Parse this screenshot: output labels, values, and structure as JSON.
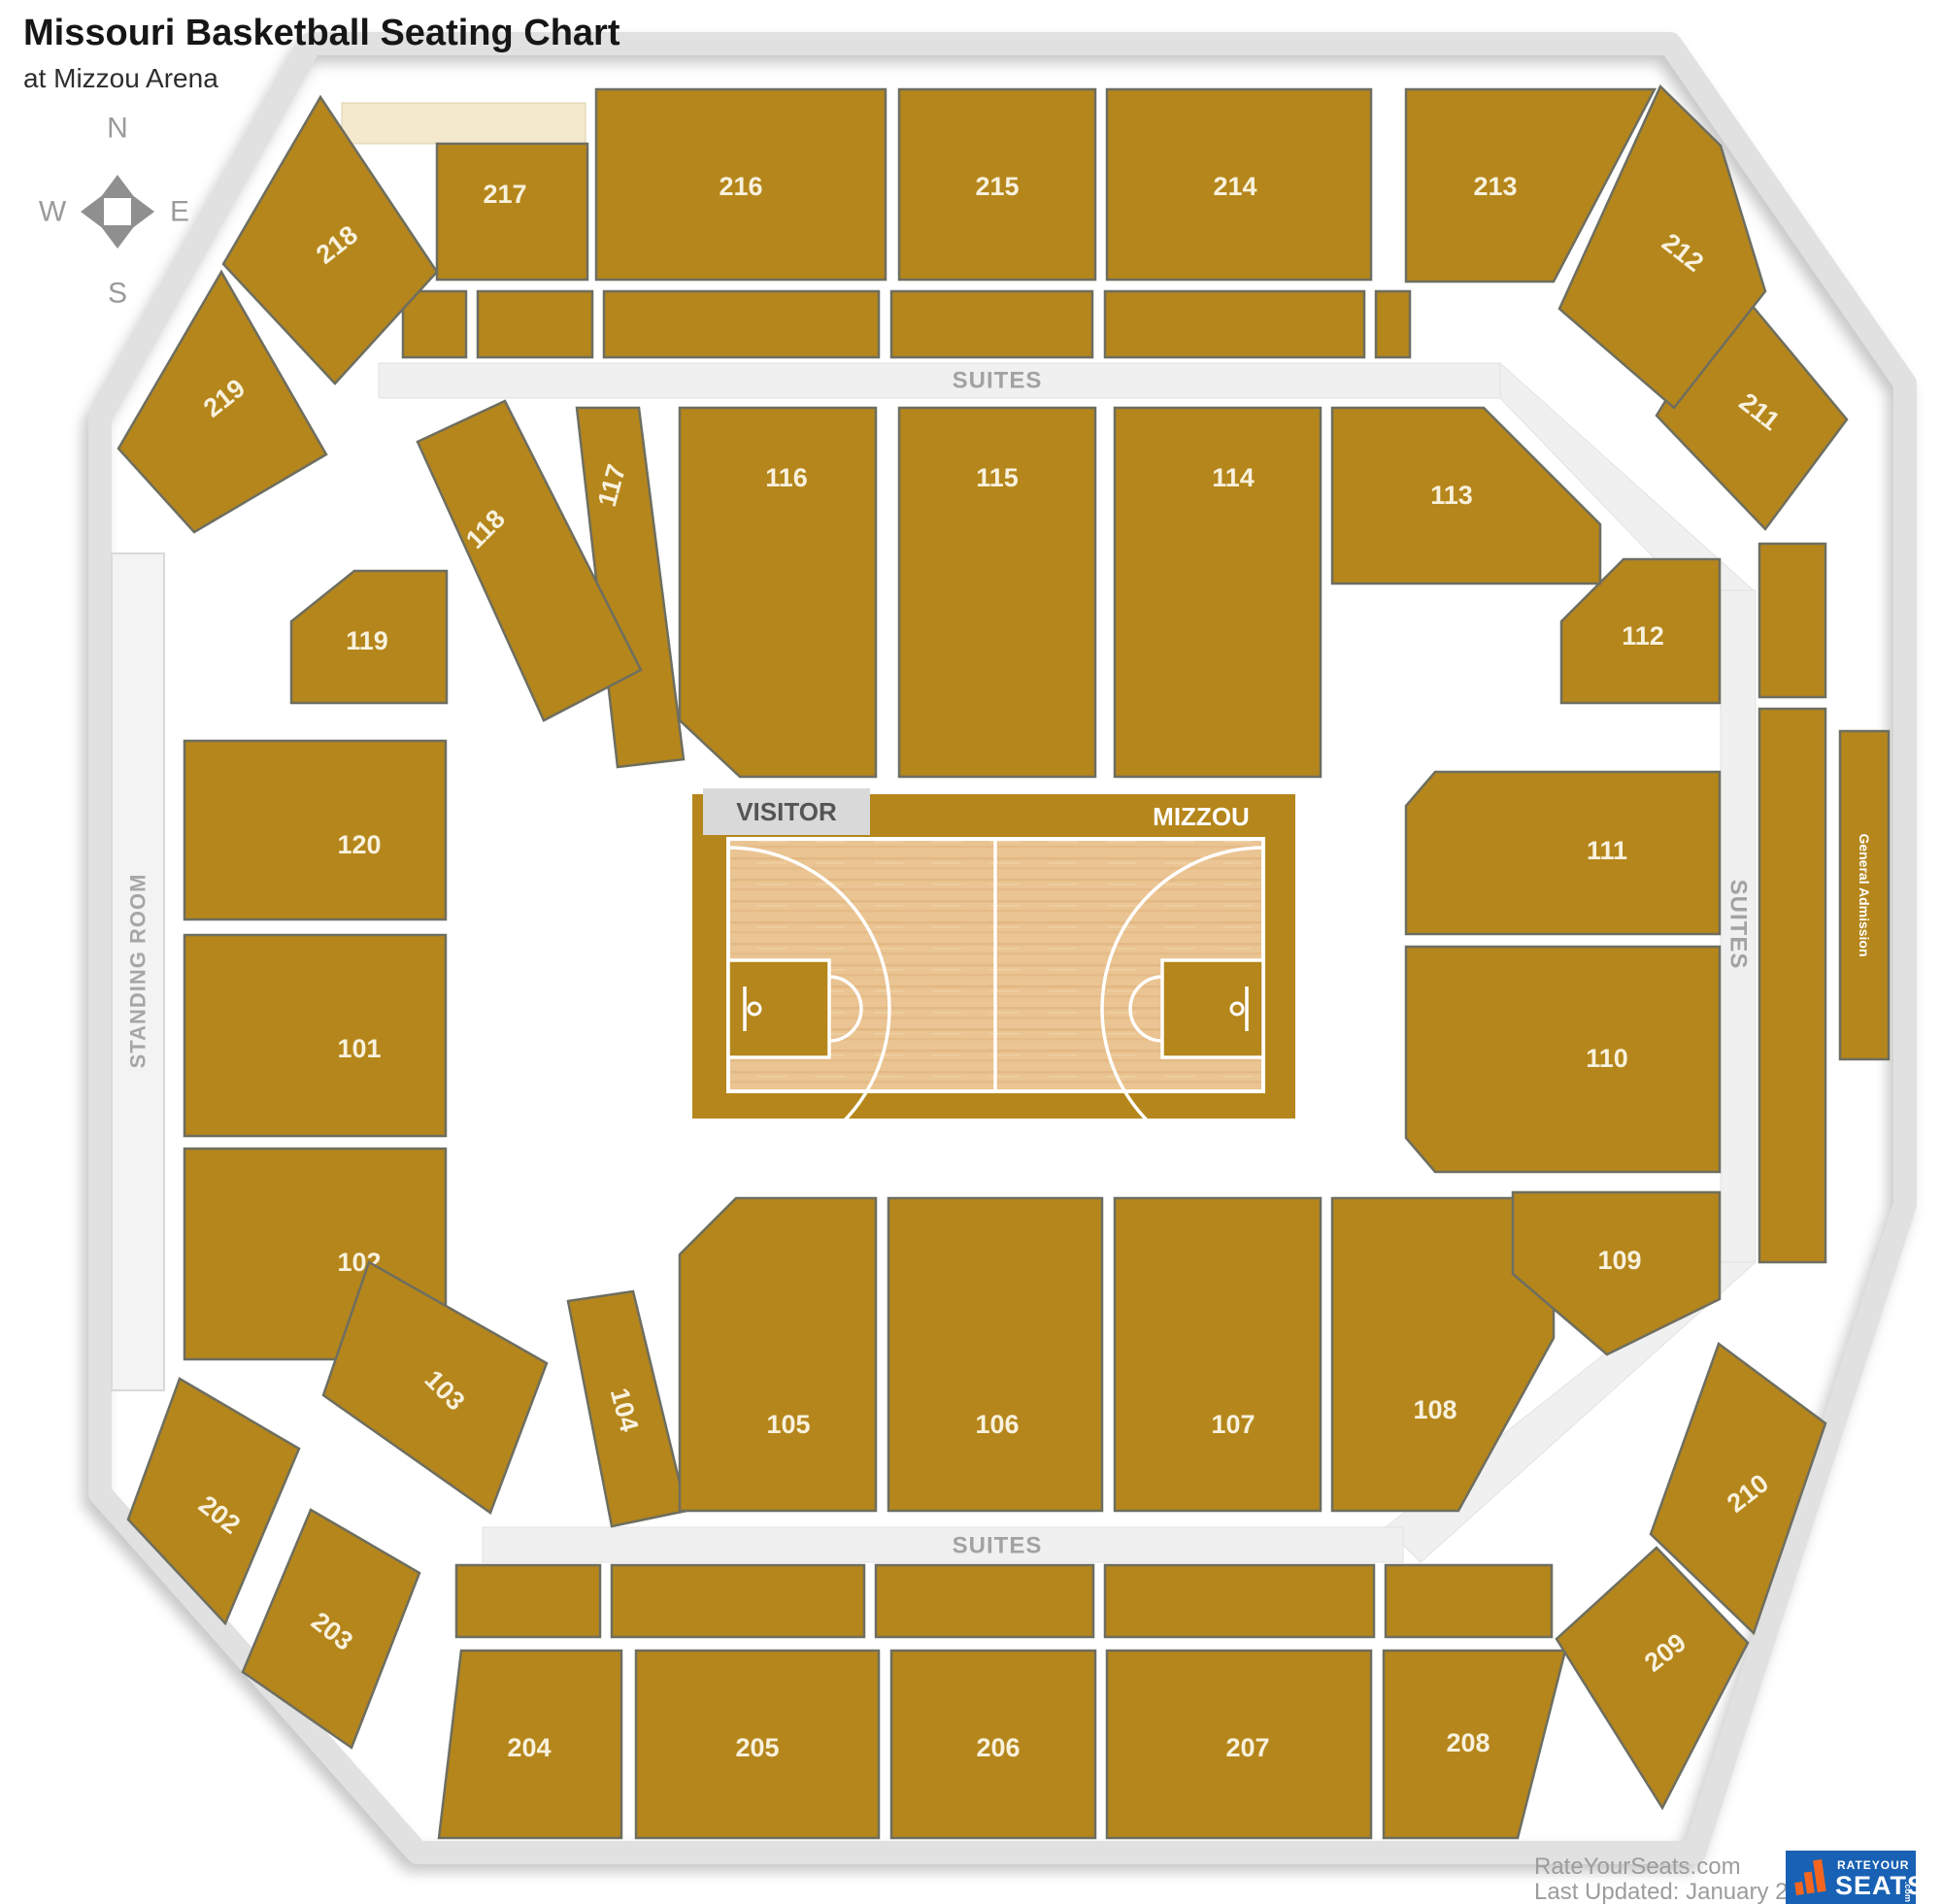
{
  "header": {
    "title": "Missouri Basketball Seating Chart",
    "subtitle": "at Mizzou Arena"
  },
  "compass": {
    "north": "N",
    "west": "W",
    "east": "E",
    "south": "S"
  },
  "areas": {
    "suites_top": "SUITES",
    "suites_bottom": "SUITES",
    "suites_right": "SUITES",
    "standing_room": "STANDING ROOM",
    "general_admission": "General Admission"
  },
  "court": {
    "visitor_bench": "VISITOR",
    "home_bench": "MIZZOU"
  },
  "sections": [
    {
      "id": "101",
      "label": "101"
    },
    {
      "id": "102",
      "label": "102"
    },
    {
      "id": "103",
      "label": "103"
    },
    {
      "id": "104",
      "label": "104"
    },
    {
      "id": "105",
      "label": "105"
    },
    {
      "id": "106",
      "label": "106"
    },
    {
      "id": "107",
      "label": "107"
    },
    {
      "id": "108",
      "label": "108"
    },
    {
      "id": "109",
      "label": "109"
    },
    {
      "id": "110",
      "label": "110"
    },
    {
      "id": "111",
      "label": "111"
    },
    {
      "id": "112",
      "label": "112"
    },
    {
      "id": "113",
      "label": "113"
    },
    {
      "id": "114",
      "label": "114"
    },
    {
      "id": "115",
      "label": "115"
    },
    {
      "id": "116",
      "label": "116"
    },
    {
      "id": "117",
      "label": "117"
    },
    {
      "id": "118",
      "label": "118"
    },
    {
      "id": "119",
      "label": "119"
    },
    {
      "id": "120",
      "label": "120"
    },
    {
      "id": "202",
      "label": "202"
    },
    {
      "id": "203",
      "label": "203"
    },
    {
      "id": "204",
      "label": "204"
    },
    {
      "id": "205",
      "label": "205"
    },
    {
      "id": "206",
      "label": "206"
    },
    {
      "id": "207",
      "label": "207"
    },
    {
      "id": "208",
      "label": "208"
    },
    {
      "id": "209",
      "label": "209"
    },
    {
      "id": "210",
      "label": "210"
    },
    {
      "id": "211",
      "label": "211"
    },
    {
      "id": "212",
      "label": "212"
    },
    {
      "id": "213",
      "label": "213"
    },
    {
      "id": "214",
      "label": "214"
    },
    {
      "id": "215",
      "label": "215"
    },
    {
      "id": "216",
      "label": "216"
    },
    {
      "id": "217",
      "label": "217"
    },
    {
      "id": "218",
      "label": "218"
    },
    {
      "id": "219",
      "label": "219"
    }
  ],
  "footer": {
    "site": "RateYourSeats.com",
    "updated": "Last Updated: January 28, 2023",
    "logo_line1": "RATEYOUR",
    "logo_line2": "SEATS",
    "logo_dotcom": ".com"
  },
  "colors": {
    "section_gold": "#b5861b",
    "band_gray": "#f0f0f0",
    "wood": "#eac492",
    "logo_blue": "#1961b4",
    "logo_orange": "#f4661f"
  }
}
